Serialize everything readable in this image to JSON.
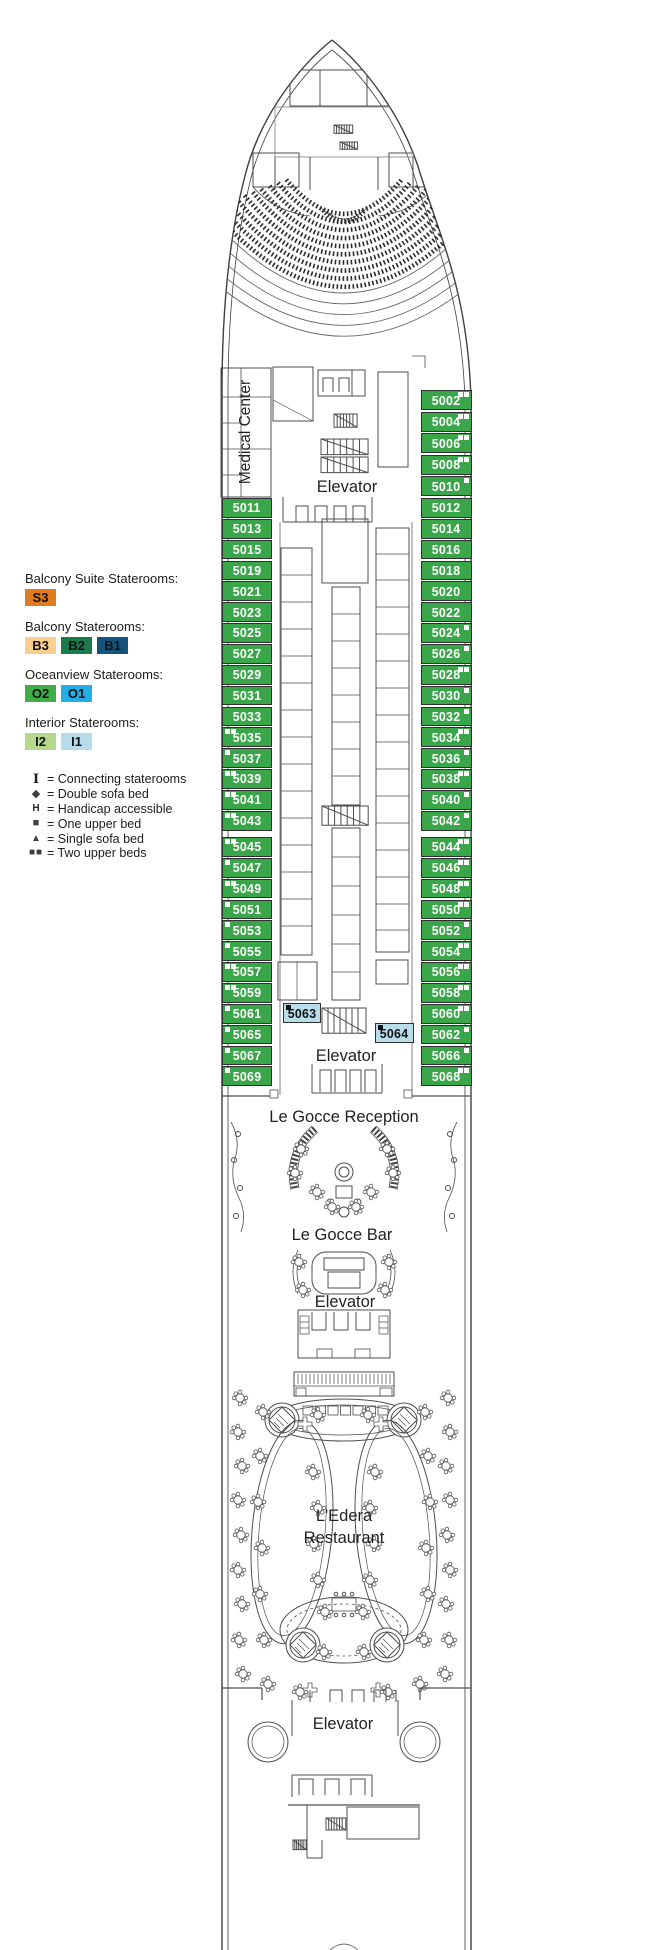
{
  "legend": {
    "sections": [
      {
        "title": "Balcony Suite Staterooms:",
        "chips": [
          {
            "label": "S3",
            "bg": "#e07c1f"
          }
        ]
      },
      {
        "title": "Balcony Staterooms:",
        "chips": [
          {
            "label": "B3",
            "bg": "#f9cf8f"
          },
          {
            "label": "B2",
            "bg": "#1b7b4c"
          },
          {
            "label": "B1",
            "bg": "#15537f"
          }
        ]
      },
      {
        "title": "Oceanview Staterooms:",
        "chips": [
          {
            "label": "O2",
            "bg": "#3fae49"
          },
          {
            "label": "O1",
            "bg": "#25aee6"
          }
        ]
      },
      {
        "title": "Interior Staterooms:",
        "chips": [
          {
            "label": "I2",
            "bg": "#b4d88c"
          },
          {
            "label": "I1",
            "bg": "#b6dcea"
          }
        ]
      }
    ],
    "symbols": [
      {
        "type": "ibeam",
        "glyph": "I",
        "label": "= Connecting staterooms"
      },
      {
        "type": "diamond",
        "glyph": "◆",
        "label": "= Double sofa bed"
      },
      {
        "type": "h",
        "glyph": "H",
        "label": "= Handicap accessible"
      },
      {
        "type": "square",
        "glyph": "■",
        "label": "= One upper bed"
      },
      {
        "type": "triangle",
        "glyph": "▲",
        "label": "= Single sofa bed"
      },
      {
        "type": "two",
        "glyph": "■■",
        "label": "= Two upper beds"
      }
    ]
  },
  "labels": {
    "medical_center": "Medical Center",
    "elevator": "Elevator",
    "reception": "Le Gocce Reception",
    "bar": "Le Gocce Bar",
    "restaurant_line1": "L'Edera",
    "restaurant_line2": "Restaurant"
  },
  "colors": {
    "stateroom_green": "#3aa64a",
    "interior_blue": "#b9dcea",
    "line": "#4d4d4d"
  },
  "rooms": {
    "right_forward": [
      {
        "n": "5002",
        "m": 2
      },
      {
        "n": "5004",
        "m": 2
      },
      {
        "n": "5006",
        "m": 2
      },
      {
        "n": "5008",
        "m": 2
      },
      {
        "n": "5010",
        "m": 1
      }
    ],
    "left_forward": [
      {
        "n": "5011",
        "m": 0
      },
      {
        "n": "5013",
        "m": 0
      },
      {
        "n": "5015",
        "m": 0
      },
      {
        "n": "5019",
        "m": 0
      },
      {
        "n": "5021",
        "m": 0
      },
      {
        "n": "5023",
        "m": 0
      },
      {
        "n": "5025",
        "m": 0
      },
      {
        "n": "5027",
        "m": 0
      },
      {
        "n": "5029",
        "m": 0
      },
      {
        "n": "5031",
        "m": 0
      },
      {
        "n": "5033",
        "m": 0
      },
      {
        "n": "5035",
        "m": 2
      },
      {
        "n": "5037",
        "m": 1
      },
      {
        "n": "5039",
        "m": 2
      },
      {
        "n": "5041",
        "m": 2
      },
      {
        "n": "5043",
        "m": 2
      }
    ],
    "left_aft": [
      {
        "n": "5045",
        "m": 2
      },
      {
        "n": "5047",
        "m": 1
      },
      {
        "n": "5049",
        "m": 2
      },
      {
        "n": "5051",
        "m": 1
      },
      {
        "n": "5053",
        "m": 1
      },
      {
        "n": "5055",
        "m": 1
      },
      {
        "n": "5057",
        "m": 2
      },
      {
        "n": "5059",
        "m": 2
      },
      {
        "n": "5061",
        "m": 1
      },
      {
        "n": "5065",
        "m": 1
      },
      {
        "n": "5067",
        "m": 1
      },
      {
        "n": "5069",
        "m": 1
      }
    ],
    "right_mid": [
      {
        "n": "5012",
        "m": 0
      },
      {
        "n": "5014",
        "m": 0
      },
      {
        "n": "5016",
        "m": 0
      },
      {
        "n": "5018",
        "m": 0
      },
      {
        "n": "5020",
        "m": 0
      },
      {
        "n": "5022",
        "m": 0
      },
      {
        "n": "5024",
        "m": 1
      },
      {
        "n": "5026",
        "m": 1
      },
      {
        "n": "5028",
        "m": 2
      },
      {
        "n": "5030",
        "m": 1
      },
      {
        "n": "5032",
        "m": 1
      },
      {
        "n": "5034",
        "m": 2
      },
      {
        "n": "5036",
        "m": 1
      },
      {
        "n": "5038",
        "m": 2
      },
      {
        "n": "5040",
        "m": 1
      },
      {
        "n": "5042",
        "m": 1
      }
    ],
    "right_aft": [
      {
        "n": "5044",
        "m": 2
      },
      {
        "n": "5046",
        "m": 2
      },
      {
        "n": "5048",
        "m": 2
      },
      {
        "n": "5050",
        "m": 2
      },
      {
        "n": "5052",
        "m": 1
      },
      {
        "n": "5054",
        "m": 2
      },
      {
        "n": "5056",
        "m": 2
      },
      {
        "n": "5058",
        "m": 2
      },
      {
        "n": "5060",
        "m": 2
      },
      {
        "n": "5062",
        "m": 1
      },
      {
        "n": "5066",
        "m": 1
      },
      {
        "n": "5068",
        "m": 2
      }
    ],
    "interior_blue": [
      {
        "n": "5063",
        "m": 1
      },
      {
        "n": "5064",
        "m": 1
      }
    ]
  }
}
